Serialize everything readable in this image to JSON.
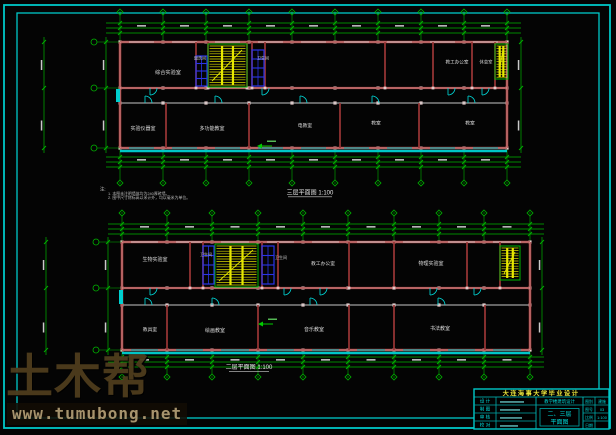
{
  "watermark": {
    "brand": "土木帮",
    "url": "www.tumubong.net"
  },
  "plans": {
    "upper": {
      "caption": "三层平面图 1:100",
      "note_heading": "注:",
      "notes": [
        "1. 本图未注明墙体均为240厚砖墙。",
        "2. 图中尺寸除标高以米计外，均以毫米为单位。"
      ],
      "rooms_top": [
        "综合实验室",
        "盥洗间",
        "卫生间",
        "教工办公室",
        "休息室"
      ],
      "rooms_bottom": [
        "实验仪器室",
        "多功能教室",
        "电教室",
        "教室",
        "教室"
      ]
    },
    "lower": {
      "caption": "二层平面图 1:100",
      "rooms_top": [
        "生物实验室",
        "卫生间",
        "卫生间",
        "教工办公室",
        "物理实验室"
      ],
      "rooms_bottom": [
        "教具室",
        "绘画教室",
        "音乐教室",
        "书法教室"
      ]
    }
  },
  "title_block": {
    "header": "大连海事大学毕业设计",
    "left_rows": [
      "设 计",
      "制 图",
      "审 核",
      "校 对"
    ],
    "project_value": "教学楼建筑设计",
    "drawing_title_line1": "二、三层",
    "drawing_title_line2": "平面图",
    "right_rows": [
      [
        "图别",
        "建施"
      ],
      [
        "图号",
        "03"
      ],
      [
        "比例",
        "1:100"
      ],
      [
        "日期",
        ""
      ]
    ]
  },
  "colors": {
    "frame": "#00c8c8",
    "grid": "#00b400",
    "wall": "#9b3535",
    "wall_highlight": "#e8b4b4",
    "accent": "#00dcdc",
    "stair": "#e0e000",
    "fixture": "#2a35e8",
    "label_text": "#dcdcdc",
    "title_text": "#00d8d8",
    "header_text": "#e8e23c",
    "watermark_brand": "#4d3c1c",
    "watermark_url": "#a6936d"
  }
}
